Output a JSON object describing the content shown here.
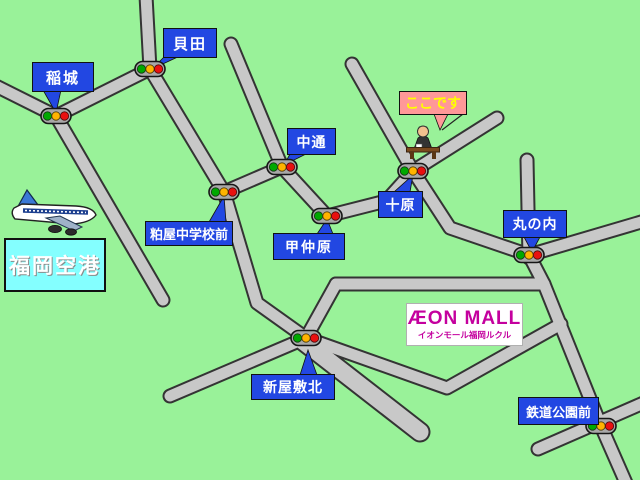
{
  "places": [
    {
      "name": "稲城"
    },
    {
      "name": "貝田"
    },
    {
      "name": "中通"
    },
    {
      "name": "十原"
    },
    {
      "name": "甲仲原"
    },
    {
      "name": "粕屋中学校前"
    },
    {
      "name": "丸の内"
    },
    {
      "name": "新屋敷北"
    },
    {
      "name": "鉄道公園前"
    }
  ],
  "here_label": {
    "text": "ここです"
  },
  "airport_label": {
    "text": "福岡空港"
  },
  "aeon_mall": {
    "logo": "ÆON MALL",
    "subtitle": "イオンモール福岡ルクル"
  },
  "icons": {
    "traffic_light": "traffic-light-icon",
    "airplane": "airplane-icon",
    "person_at_desk": "person-at-desk-icon"
  },
  "colors": {
    "background": "#99f299",
    "road_fill": "#c8c8c8",
    "road_outline": "#343434",
    "label_blue": "#2247e2",
    "label_text": "#ffffff",
    "here_bg": "#ff9898",
    "here_text": "#ffff00",
    "airport_bg": "#84ffff",
    "aeon_magenta": "#c4009e",
    "signal_green": "#00a800",
    "signal_yellow": "#ffb300",
    "signal_red": "#e81010"
  }
}
